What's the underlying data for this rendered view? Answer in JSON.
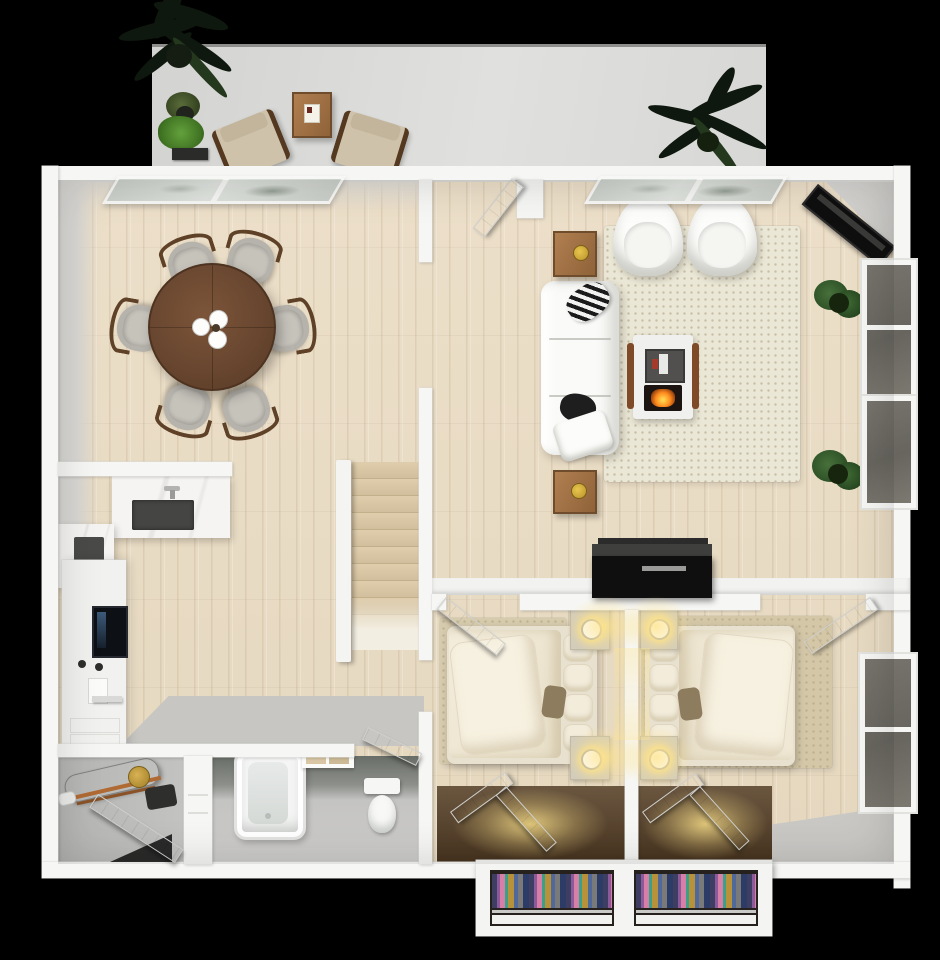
{
  "meta": {
    "type": "3d-floor-plan-render",
    "view": "top-down",
    "canvas": {
      "width": 940,
      "height": 960
    },
    "visible_text": "none"
  },
  "colors": {
    "wall": "#f6f6f4",
    "wood": "#e9dec7",
    "grayfloor": "#c7c6c3",
    "patio": "#d9d9d7",
    "tablewood": "#6b4831",
    "sofa": "#fafaf8",
    "rugliving": "#ebe7d6",
    "rugbed": "#d7cbae",
    "fire": "#ff8a1e",
    "lampglow": "#ffe48c",
    "tv": "#0f0f0f",
    "glass": "#6f6d65",
    "topglass": "#d3d8d2",
    "plantdark": "#0e180e",
    "plantgreen": "#4f8c2e",
    "closetdark": "#27211d",
    "cl1": "#3e3e62",
    "cl2": "#8a5a9a",
    "cl3": "#d87fa8",
    "cl4": "#3aa08a",
    "cl5": "#b8923a",
    "cl6": "#4f6a9a",
    "cl7": "#7a7a7a",
    "cl8": "#2c3c66"
  },
  "rooms": [
    {
      "name": "patio",
      "floor": "concrete",
      "furniture": [
        "large-palm-plant",
        "potted-plant",
        "fern-plant",
        "wood-side-table",
        "lounge-chair",
        "lounge-chair",
        "large-palm-plant"
      ]
    },
    {
      "name": "dining-room",
      "floor": "wood",
      "furniture": [
        "round-dining-table",
        "dining-chair",
        "dining-chair",
        "dining-chair",
        "dining-chair",
        "dining-chair",
        "dining-chair",
        "candle-centerpiece"
      ]
    },
    {
      "name": "living-room",
      "floor": "wood",
      "furniture": [
        "area-rug",
        "sofa",
        "armchair",
        "armchair",
        "fireplace-media-unit",
        "corner-tv",
        "side-table",
        "side-table",
        "potted-plant",
        "potted-plant",
        "black-dresser"
      ]
    },
    {
      "name": "kitchen",
      "floor": "wood",
      "furniture": [
        "marble-island-cooktop",
        "marble-counter-sink",
        "cabinet-column",
        "wall-oven",
        "towel-bar"
      ]
    },
    {
      "name": "staircase",
      "floor": "wood",
      "furniture": [
        "stair-treads",
        "stair-railing"
      ]
    },
    {
      "name": "hallway",
      "floor": "gray"
    },
    {
      "name": "bathroom",
      "floor": "gray",
      "furniture": [
        "bathtub",
        "toilet",
        "towel-shelf"
      ]
    },
    {
      "name": "utility-room",
      "floor": "gray",
      "furniture": [
        "water-heater",
        "pipes"
      ]
    },
    {
      "name": "bedroom-1",
      "floor": "wood",
      "furniture": [
        "area-rug",
        "double-bed",
        "nightstand-lamp",
        "nightstand-lamp",
        "closet-lit"
      ]
    },
    {
      "name": "bedroom-2",
      "floor": "wood",
      "furniture": [
        "area-rug",
        "double-bed",
        "nightstand-lamp",
        "nightstand-lamp",
        "closet-lit"
      ]
    }
  ],
  "windows": {
    "top_wall": 2,
    "right_wall_living": 2,
    "right_wall_bedroom": 1
  },
  "doors": [
    "entry-door",
    "bedroom-1-door",
    "bedroom-2-door",
    "bathroom-door",
    "utility-door",
    "closet-doors"
  ]
}
